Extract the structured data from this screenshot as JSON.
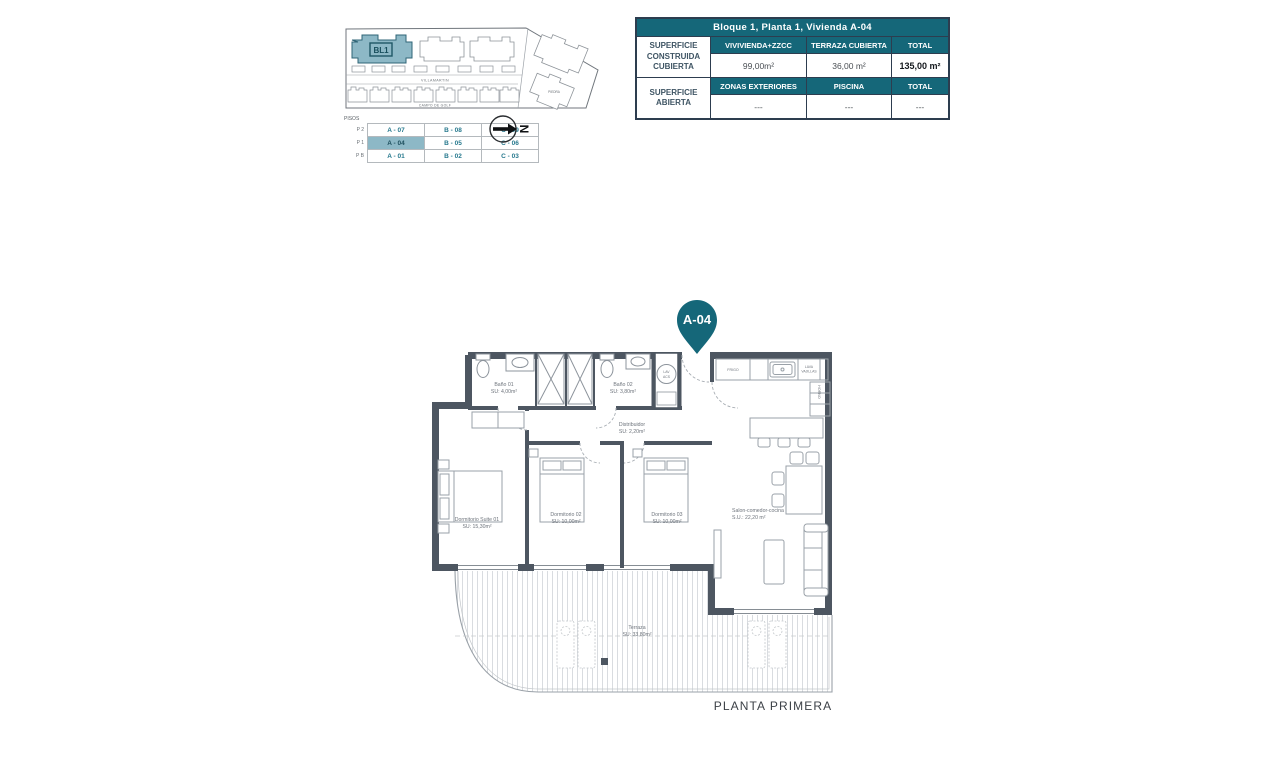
{
  "colors": {
    "teal": "#156779",
    "teal_light": "#8db8c6",
    "wall": "#4d5661"
  },
  "site_plan": {
    "block_label": "BL1",
    "road_top": "VILLAMARTIN",
    "road_bottom": "CAMPO DE GOLF",
    "area_label": "PIEDRA",
    "compass_letter": "N"
  },
  "floors_table": {
    "title": "PISOS",
    "rows": [
      {
        "floor": "P 2",
        "units": [
          "A - 07",
          "B - 08",
          "C - 09"
        ]
      },
      {
        "floor": "P 1",
        "units": [
          "A - 04",
          "B - 05",
          "C - 06"
        ]
      },
      {
        "floor": "P B",
        "units": [
          "A - 01",
          "B - 02",
          "C - 03"
        ]
      }
    ]
  },
  "summary_table": {
    "title": "Bloque 1, Planta 1, Vivienda A-04",
    "rows": [
      {
        "label": "SUPERFICIE CONSTRUIDA CUBIERTA",
        "columns": [
          "VIVIVIENDA+ZZCC",
          "TERRAZA CUBIERTA",
          "TOTAL"
        ],
        "values": [
          "99,00m²",
          "36,00 m²",
          "135,00 m²"
        ]
      },
      {
        "label": "SUPERFICIE ABIERTA",
        "columns": [
          "ZONAS EXTERIORES",
          "PISCINA",
          "TOTAL"
        ],
        "values": [
          "---",
          "---",
          "---"
        ]
      }
    ]
  },
  "unit_pin": {
    "label": "A-04"
  },
  "plan": {
    "rooms": {
      "bano1": {
        "name": "Baño 01",
        "area": "SU: 4,00m²"
      },
      "bano2": {
        "name": "Baño 02",
        "area": "SU: 3,80m²"
      },
      "distribuidor": {
        "name": "Distribuidor",
        "area": "SU: 2,20m²"
      },
      "suite": {
        "name": "Dormitorio Suite 01",
        "area": "SU: 15,30m²"
      },
      "dorm2": {
        "name": "Dormitorio 02",
        "area": "SU: 10,00m²"
      },
      "dorm3": {
        "name": "Dormitorio 03",
        "area": "SU: 10,00m²"
      },
      "salon": {
        "name": "Salon-comedor-cocina",
        "area": "S.U.: 22,20 m²"
      },
      "terraza": {
        "name": "Terraza",
        "area": "SU: 33,80m²"
      }
    },
    "appliances": {
      "fridge": "FRIGO",
      "dishwasher_1": "LAVA",
      "dishwasher_2": "VAJILLAS",
      "oven": "HORNO",
      "laundry_1": "LAV",
      "laundry_2": "ACS"
    }
  },
  "footer": {
    "caption": "PLANTA PRIMERA"
  }
}
